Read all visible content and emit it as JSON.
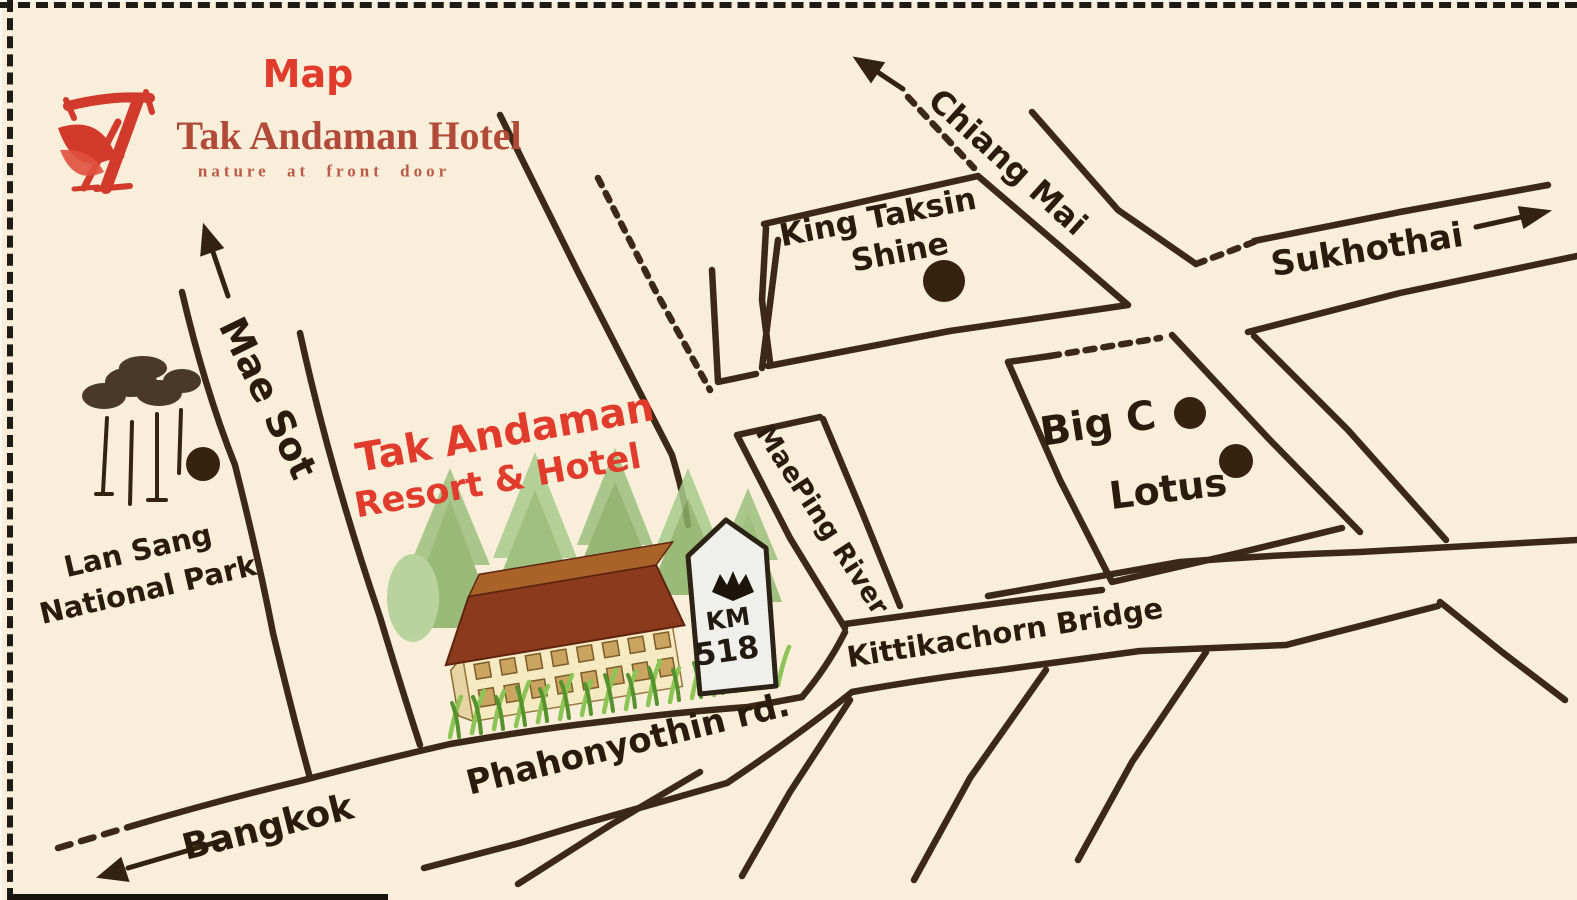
{
  "header": {
    "map_label": "Map",
    "brand": {
      "name": "Tak Andaman Hotel",
      "tagline": "nature at front door",
      "logo_icon": "tak-andaman-monogram-icon"
    }
  },
  "roads": [
    {
      "id": "mae-sot",
      "label": "Mae Sot",
      "arrow": "up"
    },
    {
      "id": "chiang-mai",
      "label": "Chiang Mai",
      "arrow": "up-left"
    },
    {
      "id": "sukhothai",
      "label": "Sukhothai",
      "arrow": "right"
    },
    {
      "id": "bangkok",
      "label": "Bangkok",
      "arrow": "down-left"
    },
    {
      "id": "phahonyothin",
      "label": "Phahonyothin rd."
    },
    {
      "id": "kittikachorn-bridge",
      "label": "Kittikachorn Bridge"
    },
    {
      "id": "maeping-river",
      "label": "MaePing River"
    }
  ],
  "places": [
    {
      "id": "king-taksin-shine",
      "line1": "King Taksin",
      "line2": "Shine",
      "marker": "dot"
    },
    {
      "id": "big-c",
      "line1": "Big C",
      "marker": "dot"
    },
    {
      "id": "lotus",
      "line1": "Lotus",
      "marker": "dot"
    },
    {
      "id": "lan-sang-national-park",
      "line1": "Lan Sang",
      "line2": "National Park",
      "marker": "dot-and-trees"
    },
    {
      "id": "tak-andaman-resort",
      "line1": "Tak Andaman",
      "line2": "Resort & Hotel",
      "marker": "building-illustration"
    }
  ],
  "milestone": {
    "line1": "KM",
    "line2": "518",
    "emblem": "garuda-bird-icon"
  },
  "colors": {
    "background": "#f8eed9",
    "ink": "#3c2817",
    "label_ink": "#2b1b0c",
    "accent_red": "#e13b2c",
    "brand_red": "#b24a3a",
    "roof_brown": "#8b3b1b",
    "wall_cream": "#f6eac2",
    "stone_white": "#eff0eb",
    "grass_green": "#6fae3f"
  }
}
